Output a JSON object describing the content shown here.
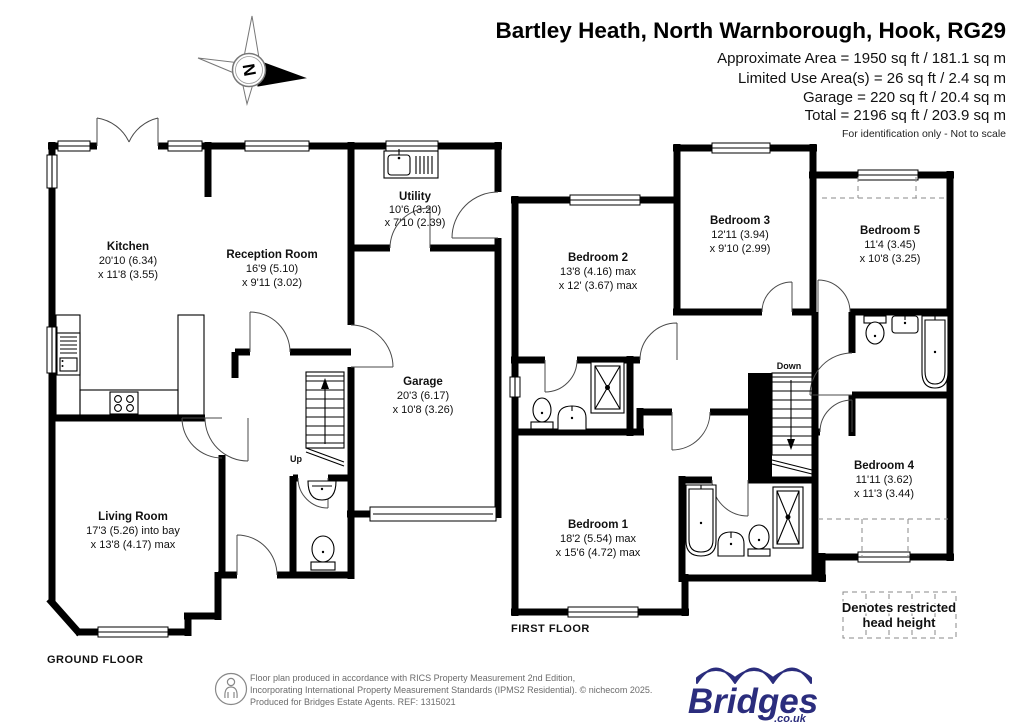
{
  "header": {
    "title": "Bartley Heath, North Warnborough, Hook, RG29",
    "area_lines": [
      "Approximate Area = 1950 sq ft / 181.1 sq m",
      "Limited Use Area(s) = 26 sq ft / 2.4 sq m",
      "Garage = 220 sq ft / 20.4 sq m",
      "Total = 2196 sq ft / 203.9 sq m"
    ],
    "note": "For identification only - Not to scale"
  },
  "compass": {
    "north_label": "N"
  },
  "ground_floor": {
    "label": "GROUND FLOOR",
    "stairs_label": "Up",
    "rooms": {
      "kitchen": {
        "name": "Kitchen",
        "dim1": "20'10 (6.34)",
        "dim2": "x 11'8 (3.55)"
      },
      "reception": {
        "name": "Reception Room",
        "dim1": "16'9 (5.10)",
        "dim2": "x 9'11 (3.02)"
      },
      "utility": {
        "name": "Utility",
        "dim1": "10'6 (3.20)",
        "dim2": "x 7'10 (2.39)"
      },
      "garage": {
        "name": "Garage",
        "dim1": "20'3 (6.17)",
        "dim2": "x 10'8 (3.26)"
      },
      "living": {
        "name": "Living Room",
        "dim1": "17'3 (5.26) into bay",
        "dim2": "x 13'8 (4.17) max"
      }
    }
  },
  "first_floor": {
    "label": "FIRST FLOOR",
    "stairs_label": "Down",
    "rooms": {
      "bedroom1": {
        "name": "Bedroom 1",
        "dim1": "18'2 (5.54) max",
        "dim2": "x 15'6 (4.72) max"
      },
      "bedroom2": {
        "name": "Bedroom 2",
        "dim1": "13'8 (4.16) max",
        "dim2": "x 12' (3.67) max"
      },
      "bedroom3": {
        "name": "Bedroom 3",
        "dim1": "12'11 (3.94)",
        "dim2": "x 9'10 (2.99)"
      },
      "bedroom4": {
        "name": "Bedroom 4",
        "dim1": "11'11 (3.62)",
        "dim2": "x 11'3 (3.44)"
      },
      "bedroom5": {
        "name": "Bedroom 5",
        "dim1": "11'4 (3.45)",
        "dim2": "x 10'8 (3.25)"
      }
    }
  },
  "legend": {
    "line1": "Denotes restricted",
    "line2": "head height"
  },
  "footer": {
    "lines": [
      "Floor plan produced in accordance with RICS Property Measurement 2nd Edition,",
      "Incorporating International Property Measurement Standards (IPMS2 Residential).  © nichecom 2025.",
      "Produced for Bridges Estate Agents.   REF: 1315021"
    ]
  },
  "logo": {
    "name": "Bridges",
    "domain": ".co.uk",
    "color": "#2b2d7d"
  }
}
